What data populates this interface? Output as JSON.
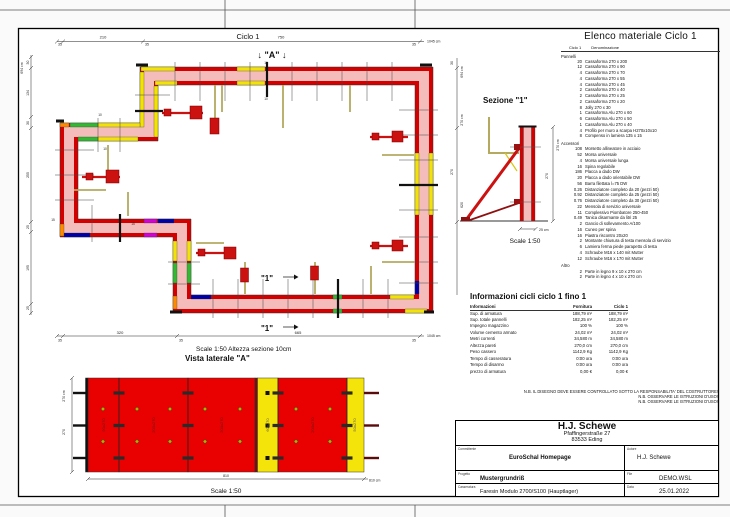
{
  "colors": {
    "panel_red": "#d40000",
    "wall_pink": "#f5bcbc",
    "accent_yellow": "#f2e205",
    "accent_green": "#2fba2f",
    "accent_blue": "#0000a8",
    "accent_magenta": "#d400d4",
    "accent_orange": "#ff8a00",
    "brace_olive": "#b5a95f",
    "brace_dark_red": "#8f1010"
  },
  "plan": {
    "title": "Ciclo 1",
    "a_marker": "↓ \"A\" ↓",
    "cut_label_1": "\"1\"",
    "cut_label_2": "\"1\"",
    "ten_top": "10",
    "ten_bottom": "10",
    "ten_left_a": "10",
    "ten_left_b": "10",
    "fifteen_a": "15",
    "fifteen_b": "15",
    "scale_note": "Scale 1:50   Altezza sezione 10cm",
    "top_dims": [
      "35",
      "210",
      "35",
      "750",
      "35",
      "1045 cm"
    ],
    "bottom_dims": [
      "35",
      "320",
      "35",
      "665",
      "35",
      "1045 cm"
    ],
    "left_dims": [
      "694 cm",
      "30",
      "134",
      "30",
      "255",
      "25",
      "195",
      "25"
    ],
    "right_dims": [
      "694 cm",
      "30",
      "270 cm",
      "270",
      "620"
    ]
  },
  "section": {
    "title": "Sezione \"1\"",
    "right_dims": [
      "270 cm",
      "270"
    ],
    "bottom_dim": "25 cm",
    "scale": "Scale 1:50"
  },
  "lateral": {
    "title": "Vista laterale \"A\"",
    "scale": "Scale 1:50",
    "left_dims": [
      "270 cm",
      "270"
    ],
    "bottom_dims": [
      "810",
      "810 cm"
    ],
    "panels": [
      {
        "label": "90x270"
      },
      {
        "label": "200x270"
      },
      {
        "label": "200x270"
      },
      {
        "label": "60x270"
      },
      {
        "label": "200x270"
      },
      {
        "label": "50x270"
      }
    ]
  },
  "materials": {
    "title": "Elenco materiale  Ciclo 1",
    "col_qty": "Ciclo 1",
    "col_name": "Denominazione",
    "sec_panels": "Pannelli",
    "sec_accessories": "Accessori",
    "sec_other": "Altro",
    "panels": [
      {
        "q": "20",
        "n": "Cassaforma 270 x 200"
      },
      {
        "q": "12",
        "n": "Cassaforma 270 x 90"
      },
      {
        "q": "4",
        "n": "Cassaforma 270 x 70"
      },
      {
        "q": "4",
        "n": "Cassaforma 270 x 55"
      },
      {
        "q": "4",
        "n": "Cassaforma 270 x 45"
      },
      {
        "q": "2",
        "n": "Cassaforma 270 x 40"
      },
      {
        "q": "2",
        "n": "Cassaforma 270 x 25"
      },
      {
        "q": "2",
        "n": "Cassaforma 270 x 20"
      },
      {
        "q": "8",
        "n": "Jolly 270 x 30"
      },
      {
        "q": "1",
        "n": "Cassaforma Alu 270 x 60"
      },
      {
        "q": "6",
        "n": "Cassaforma Alu 270 x 50"
      },
      {
        "q": "1",
        "n": "Cassaforma Alu 270 x 40"
      },
      {
        "q": "4",
        "n": "Profilo per muro a scarpa H270x10x10"
      },
      {
        "q": "8",
        "n": "Compenso in lamiera 135 x 15"
      }
    ],
    "accessories": [
      {
        "q": "108",
        "n": "Morsetto allineatore in acciaio"
      },
      {
        "q": "52",
        "n": "Morsa universale"
      },
      {
        "q": "4",
        "n": "Morsa universale lunga"
      },
      {
        "q": "16",
        "n": "Spina regolabile"
      },
      {
        "q": "186",
        "n": "Placca a dado DW"
      },
      {
        "q": "20",
        "n": "Placca a dado orientabile DW"
      },
      {
        "q": "56",
        "n": "Barra filettata l=75 DW"
      },
      {
        "q": "0.26",
        "n": "Distanziatore completo da 20 (pezzi 50)"
      },
      {
        "q": "0.92",
        "n": "Distanziatore completo da 25 (pezzi 50)"
      },
      {
        "q": "0.76",
        "n": "Distanziatore completo da 30 (pezzi 50)"
      },
      {
        "q": "22",
        "n": "Mensola di servizio universale"
      },
      {
        "q": "11",
        "n": "Complessivo Piombatore 250-450"
      },
      {
        "q": "0.49",
        "n": "Tanica disarmante da litri 25"
      },
      {
        "q": "2",
        "n": "Gancio di sollevamento A/100"
      },
      {
        "q": "16",
        "n": "Cuneo per spina"
      },
      {
        "q": "16",
        "n": "Piastra riscontro 20x20"
      },
      {
        "q": "2",
        "n": "Montante chiusura di testa mensola di servizio"
      },
      {
        "q": "6",
        "n": "Lamiera ferma piede parapetto di testa"
      },
      {
        "q": "4",
        "n": "Schraube M16 x 140 mit Mutter"
      },
      {
        "q": "12",
        "n": "Schraube M16 x 170 mit Mutter"
      }
    ],
    "other": [
      {
        "q": "2",
        "n": "Parte in legno 9 x 10 x 270 cm"
      },
      {
        "q": "2",
        "n": "Parte in legno 4 x 10 x 270 cm"
      }
    ]
  },
  "info": {
    "title": "Informazioni cicli  ciclo 1 fino 1",
    "col_label": "Informazioni",
    "col_a": "Fornitura",
    "col_b": "Ciclo 1",
    "rows": [
      {
        "l": "Sup. di armatura",
        "a": "188,79 m²",
        "b": "188,79 m²"
      },
      {
        "l": "Sup. totale pannelli",
        "a": "182,25 m²",
        "b": "182,25 m²"
      },
      {
        "l": "Impegno magazzino",
        "a": "100 %",
        "b": "100 %"
      },
      {
        "l": "Volume cemento armato",
        "a": "24,02 m³",
        "b": "24,02 m³"
      },
      {
        "l": "Metri correnti",
        "a": "34,580 m",
        "b": "34,580 m"
      },
      {
        "l": "Altezza pareti",
        "a": "270,0 cm",
        "b": "270,0 cm"
      },
      {
        "l": "Peso cassero",
        "a": "1142,9 Kg",
        "b": "1142,9 Kg"
      },
      {
        "l": "Tempo di casseratura",
        "a": "0:00 ora",
        "b": "0:00 ora"
      },
      {
        "l": "Tempo di disarmo",
        "a": "0:00 ora",
        "b": "0:00 ora"
      },
      {
        "l": "prezzo di armatura",
        "a": "0,00 €",
        "b": "0,00 €"
      }
    ]
  },
  "notes": [
    "N.B. IL DISEGNO DEVE ESSERE CONTROLLATO SOTTO LA RESPONSABILITA' DEL COSTRUTTORE!",
    "N.B. OSSERVARE LE ISTRUZIONI D'USO!",
    "N.B. OSSERVARE LE ISTRUZIONI D'USO!"
  ],
  "titleblock": {
    "company": "H.J. Schewe",
    "street": "Pfaffingerstraße 27",
    "city": "83533 Eding",
    "lbl_committente": "Committente",
    "committente": "EuroSchal Homepage",
    "lbl_autore": "Autore",
    "autore": "H.J. Schewe",
    "lbl_progetto": "Progetto",
    "progetto": "Mustergrundriß",
    "lbl_file": "File",
    "file": "DEMO.WSL",
    "lbl_casseratura": "Casseratura",
    "casseratura": "Faresin Modulo 2700/S100 (Hauptlager)",
    "lbl_data": "Data",
    "data": "25.01.2022"
  }
}
